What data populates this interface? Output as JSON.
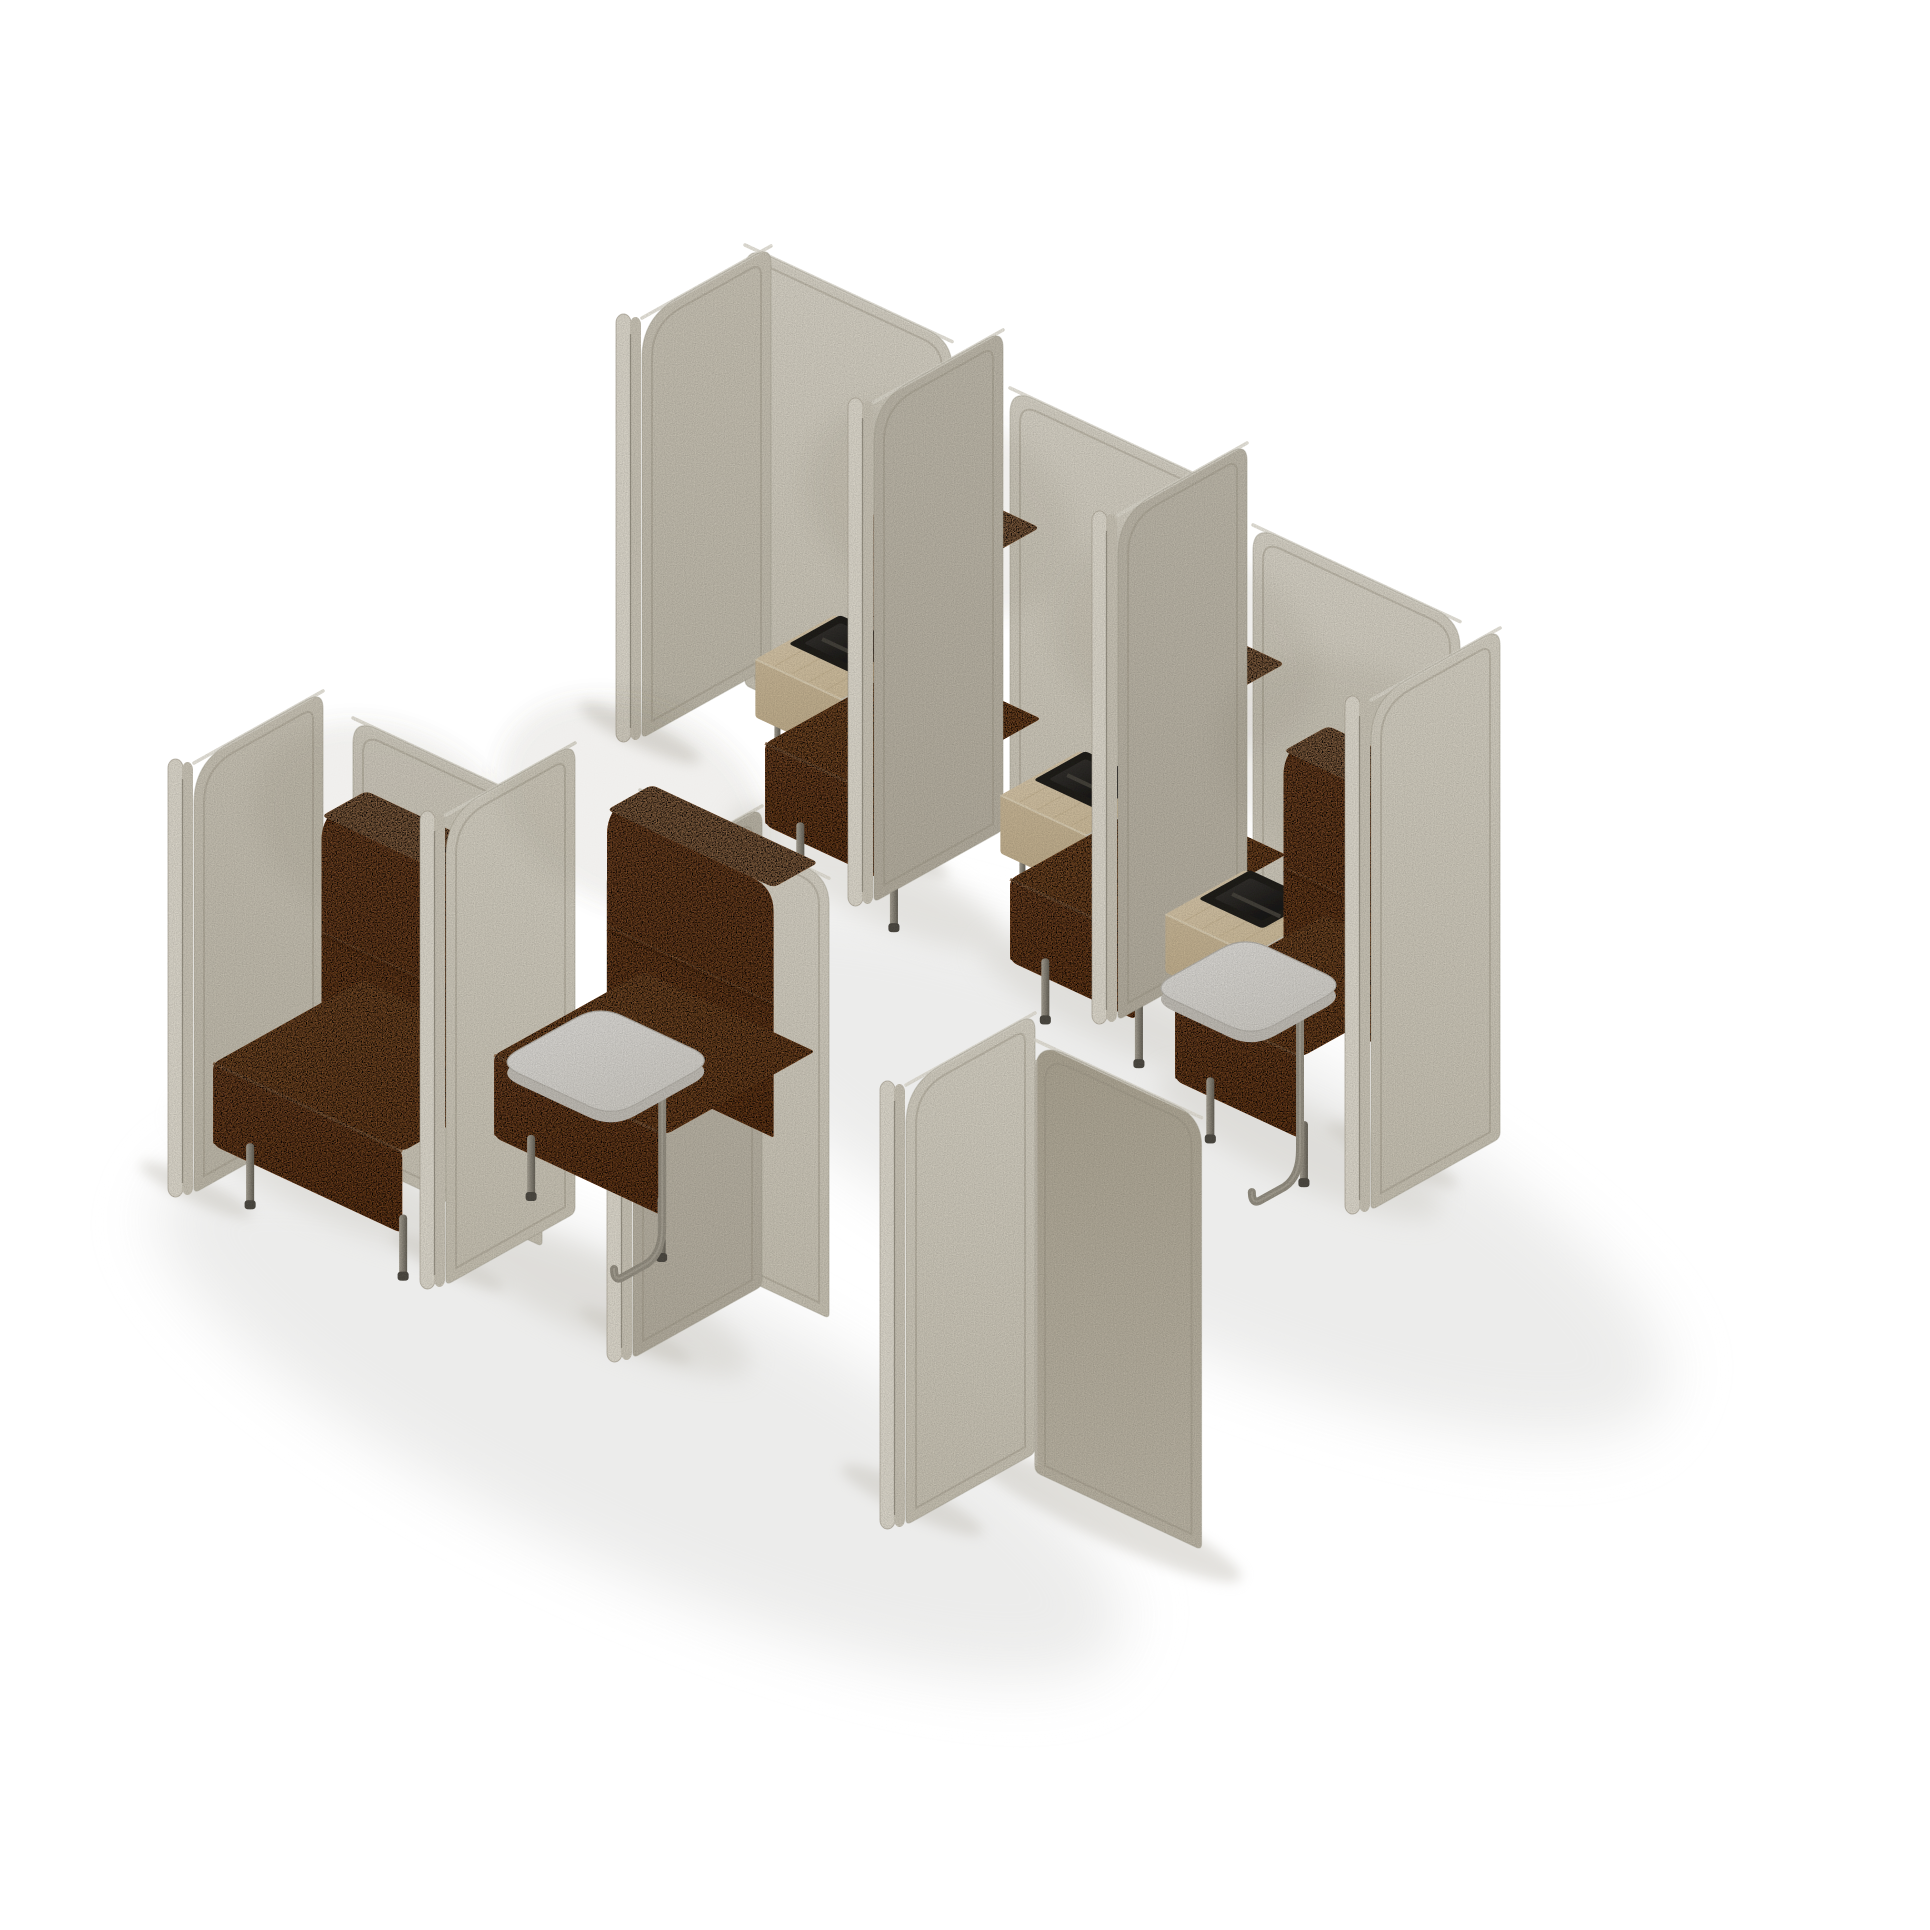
{
  "meta": {
    "type": "3d-product-render",
    "subject": "modular acoustic seating booths with side tables",
    "background": "#ffffff",
    "booth_seat_count": 5
  },
  "palette": {
    "background": "#ffffff",
    "wall": [
      "#eae5d8",
      "#d9d3c3"
    ],
    "tones": {
      "sideLit": [
        "#e7e2d4",
        "#d8d2c2"
      ],
      "sideMid": [
        "#dbd5c6",
        "#cfc9b9"
      ],
      "sideShade": [
        "#cfc9ba",
        "#c4bdad"
      ],
      "dark": [
        "#bdb5a2",
        "#cdc6b5"
      ]
    },
    "stripOuter": "#f0ebde",
    "stripInner": "#dcd6c7",
    "seam": "#8d8778",
    "rim": "#a9a292",
    "edgeLine": "#b5ae9d",
    "topHL": "#f3efe3",
    "orangeTop": [
      "#dd9254",
      "#cd7e41"
    ],
    "orangeFront": [
      "#d0824a",
      "#bf7036"
    ],
    "orangeSide": "#b96e37",
    "orangeHL": "#ecaf7a",
    "orangeSeam": "#a86430",
    "woodTop": [
      "#ead9bb",
      "#ddcaa6"
    ],
    "woodFront": [
      "#d9c6a4",
      "#cfbb96"
    ],
    "grain": "#cfbc98",
    "planterRim": "#23211e",
    "planterIn": [
      "#403d38",
      "#131211"
    ],
    "planterDiv": "#504c44",
    "tabletTop": [
      "#f1efeb",
      "#e2dfd8"
    ],
    "tabletSide": "#d3cfc7",
    "tabletStroke": "#c6c2ba",
    "leg": [
      "#b8b2a4",
      "#716c61"
    ],
    "foot": "#57534b",
    "tube": "#a39d8f",
    "tubeHL": "#c9c3b5",
    "shadowBig": "#e9e9e8",
    "shadowMid": "#d6d4cf",
    "shadowDark": "#c8c5bd",
    "ao": "#7d755f"
  },
  "projection": {
    "ux": 0.9,
    "uy": 0.42,
    "vx": -0.86,
    "vy": 0.48,
    "D": 150
  },
  "dims": {
    "table": {
      "u0": -95,
      "u1": 0,
      "v0": 0,
      "v1": 92,
      "top": 150,
      "apron": 92
    },
    "planter": {
      "u0": -83,
      "u1": -12,
      "v0": 6,
      "v1": 66,
      "top": 158,
      "inset": 7
    },
    "backrest": {
      "h0": 85,
      "h1": 335,
      "v0": 2,
      "v1": 54,
      "seam": 215,
      "r": 24
    },
    "cushion": {
      "v0": 6,
      "v1": 180,
      "top": 148,
      "bot": 66
    },
    "tablet": {
      "h": 172,
      "th": 11,
      "r": 26
    },
    "seatLeg": {
      "h": 66,
      "w": 8
    },
    "tableLeg": {
      "h": 92,
      "w": 6
    }
  },
  "rows": [
    {
      "name": "back-row",
      "walls": [
        [
          745,
          245,
          230
        ],
        [
          1010,
          388,
          230
        ],
        [
          1253,
          525,
          230
        ]
      ],
      "dividers": [
        {
          "f": [
            616,
            318
          ],
          "h": 420,
          "tone": "sideMid"
        },
        {
          "f": [
            848,
            402
          ],
          "h": 500,
          "tone": "sideShade"
        },
        {
          "f": [
            1092,
            515
          ],
          "h": 505,
          "tone": "sideShade"
        },
        {
          "f": [
            1345,
            700
          ],
          "h": 510,
          "tone": "sideLit"
        }
      ],
      "booths": [
        {
          "origin": [
            920,
            805
          ],
          "table": true,
          "planter": true,
          "cushionU": [
            0,
            140
          ],
          "backU": [
            0,
            135
          ],
          "legU": [
            18,
            122
          ],
          "tableLegU": [
            -82,
            -14
          ],
          "tablet": null
        },
        {
          "origin": [
            1165,
            941
          ],
          "table": true,
          "planter": true,
          "cushionU": [
            0,
            140
          ],
          "backU": [
            0,
            135
          ],
          "legU": [
            18,
            122
          ],
          "tableLegU": [
            -82,
            -14
          ],
          "tablet": null
        },
        {
          "origin": [
            1330,
            1060
          ],
          "table": true,
          "planter": true,
          "cushionU": [
            0,
            140
          ],
          "backU": [
            0,
            135
          ],
          "legU": [
            18,
            122
          ],
          "tableLegU": [
            -82,
            -14
          ],
          "tablet": {
            "u": [
              0,
              115
            ],
            "v": [
              100,
              210
            ],
            "legU": 110,
            "legV": 150
          }
        }
      ],
      "sequence": [
        "d0",
        "b0",
        "d1",
        "b1",
        "d2",
        "b2",
        "d3"
      ],
      "endcap": null
    },
    {
      "name": "front-row",
      "walls": [
        [
          353,
          718,
          210
        ],
        [
          640,
          790,
          210
        ]
      ],
      "dividers": [
        {
          "f": [
            168,
            763
          ],
          "h": 430,
          "tone": "sideMid"
        },
        {
          "f": [
            420,
            815
          ],
          "h": 470,
          "tone": "sideLit"
        },
        {
          "f": [
            607,
            878
          ],
          "h": 480,
          "tone": "sideShade"
        },
        {
          "f": [
            880,
            1085
          ],
          "h": 440,
          "tone": "sideLit"
        }
      ],
      "booths": [
        {
          "origin": [
            368,
            1125
          ],
          "table": false,
          "planter": false,
          "cushionU": [
            0,
            210
          ],
          "backU": [
            0,
            205
          ],
          "legU": [
            20,
            190
          ],
          "tableLegU": null,
          "tablet": null
        },
        {
          "origin": [
            613,
            1100
          ],
          "table": false,
          "planter": false,
          "cushionU": [
            40,
            230
          ],
          "backU": [
            45,
            230
          ],
          "legU": [
            60,
            205
          ],
          "tableLegU": null,
          "tablet": {
            "u": [
              75,
              205
            ],
            "v": [
              95,
              215
            ],
            "legU": 198,
            "legV": 150
          }
        }
      ],
      "sequence": [
        "d0",
        "b0",
        "d1",
        "d2",
        "b1",
        "d3",
        "cap"
      ],
      "endcap": {
        "a": [
          1035,
          1040
        ],
        "len": 185,
        "h": 432
      }
    }
  ],
  "shadows": {
    "rot": 25,
    "big": [
      [
        1170,
        1168,
        545,
        158
      ],
      [
        640,
        1418,
        530,
        150
      ]
    ],
    "mid": [
      [
        868,
        880,
        150,
        36
      ],
      [
        1118,
        1010,
        150,
        36
      ],
      [
        1300,
        1145,
        155,
        38
      ],
      [
        330,
        1178,
        165,
        40
      ],
      [
        600,
        1298,
        165,
        40
      ]
    ],
    "small": [
      [
        640,
        733,
        66,
        13
      ],
      [
        888,
        848,
        66,
        13
      ],
      [
        1130,
        962,
        66,
        13
      ],
      [
        1392,
        1155,
        72,
        14
      ],
      [
        196,
        1190,
        62,
        12
      ],
      [
        448,
        1262,
        62,
        12
      ],
      [
        635,
        1335,
        62,
        12
      ],
      [
        912,
        1500,
        78,
        15
      ],
      [
        1105,
        1515,
        150,
        24
      ]
    ]
  }
}
